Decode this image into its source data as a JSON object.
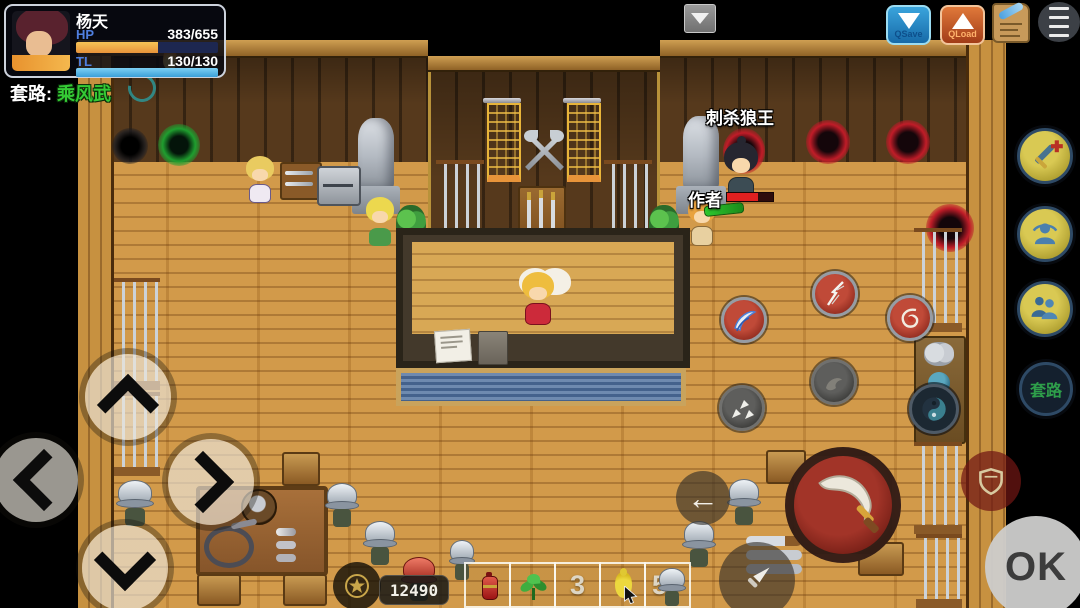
{
  "hud": {
    "name": "杨天",
    "hp_label": "HP",
    "hp_value": "383/655",
    "tl_label": "TL",
    "tl_value": "130/130",
    "combo_label": "套路:",
    "combo_value": "乘风武"
  },
  "quick_bar": {
    "qsave_label": "QSave",
    "qload_label": "QLoad"
  },
  "scene": {
    "quest_name": "刺杀狼王",
    "statue_label": "作者"
  },
  "skill_menu": {
    "taolu_label": "套路"
  },
  "action_buttons": {
    "ok_label": "OK"
  },
  "inventory": {
    "money": "12490",
    "slots": [
      {
        "name": "red-potion",
        "count": ""
      },
      {
        "name": "green-herb",
        "count": ""
      },
      {
        "name": "empty",
        "count": "3"
      },
      {
        "name": "yellow-gourd",
        "count": ""
      },
      {
        "name": "soldier-unit",
        "count": "5"
      }
    ]
  },
  "colors": {
    "hp_bar": "#f0a23c",
    "tl_bar": "#55b9ea",
    "accent_red": "#b03028",
    "button_yellow": "#c8b844",
    "combo_green": "#35cb35"
  }
}
